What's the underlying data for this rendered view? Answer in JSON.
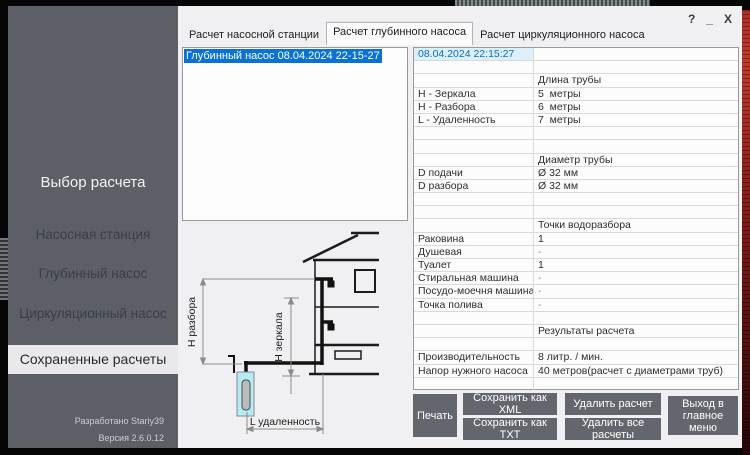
{
  "window_controls": {
    "help": "?",
    "minimize": "_",
    "close": "X"
  },
  "sidebar": {
    "title": "Выбор расчета",
    "items": [
      {
        "label": "Насосная станция",
        "active": false
      },
      {
        "label": "Глубинный насос",
        "active": false
      },
      {
        "label": "Циркуляционный насос",
        "active": false
      },
      {
        "label": "Сохраненные расчеты",
        "active": true
      }
    ],
    "footer": {
      "developed_by": "Разработано  Stariy39",
      "version": "Версия 2.6.0.12"
    }
  },
  "tabs": [
    {
      "label": "Расчет насосной станции",
      "active": false
    },
    {
      "label": "Расчет глубинного насоса",
      "active": true
    },
    {
      "label": "Расчет циркуляционного насоса",
      "active": false
    }
  ],
  "saved_list": {
    "items": [
      {
        "label": "Глубинный насос 08.04.2024 22-15-27",
        "selected": true
      }
    ]
  },
  "diagram": {
    "labels": {
      "h_razbora": "H разбора",
      "h_zerkala": "H зеркала",
      "l_udalennost": "L удаленность"
    },
    "well_color": "#b5ecf4"
  },
  "details_table": {
    "rows": [
      {
        "label": "08.04.2024 22:15:27",
        "value": "",
        "kind": "date"
      },
      {
        "label": "",
        "value": "",
        "kind": "empty"
      },
      {
        "label": "",
        "value": "Длина трубы",
        "kind": "section"
      },
      {
        "label": "H - Зеркала",
        "value": "5  метры",
        "kind": "data"
      },
      {
        "label": "H - Разбора",
        "value": "6  метры",
        "kind": "data"
      },
      {
        "label": "L - Удаленность",
        "value": "7  метры",
        "kind": "data"
      },
      {
        "label": "",
        "value": "",
        "kind": "empty"
      },
      {
        "label": "",
        "value": "",
        "kind": "empty"
      },
      {
        "label": "",
        "value": "Диаметр трубы",
        "kind": "section"
      },
      {
        "label": "D подачи",
        "value": "Ø 32 мм",
        "kind": "data"
      },
      {
        "label": "D разбора",
        "value": "Ø 32 мм",
        "kind": "data"
      },
      {
        "label": "",
        "value": "",
        "kind": "empty"
      },
      {
        "label": "",
        "value": "",
        "kind": "empty"
      },
      {
        "label": "",
        "value": "Точки водоразбора",
        "kind": "section"
      },
      {
        "label": "Раковина",
        "value": "1",
        "kind": "data"
      },
      {
        "label": "Душевая",
        "value": "-",
        "kind": "data"
      },
      {
        "label": "Туалет",
        "value": "1",
        "kind": "data"
      },
      {
        "label": "Стиральная машина",
        "value": "-",
        "kind": "data"
      },
      {
        "label": "Посудо-моечня машина",
        "value": "-",
        "kind": "data"
      },
      {
        "label": "Точка полива",
        "value": "-",
        "kind": "data"
      },
      {
        "label": "",
        "value": "",
        "kind": "empty"
      },
      {
        "label": "",
        "value": "Результаты расчета",
        "kind": "section"
      },
      {
        "label": "",
        "value": "",
        "kind": "empty"
      },
      {
        "label": "Производительность",
        "value": "8 литр. / мин.",
        "kind": "data"
      },
      {
        "label": "Напор нужного насоса",
        "value": "40 метров(расчет с диаметрами труб)",
        "kind": "data"
      },
      {
        "label": "",
        "value": "",
        "kind": "empty"
      }
    ]
  },
  "buttons": {
    "print": "Печать",
    "save_xml": "Сохранить как XML",
    "save_txt": "Сохранить как TXT",
    "delete_calc": "Удалить расчет",
    "delete_all": "Удалить все расчеты",
    "exit": "Выход в главное меню"
  },
  "colors": {
    "sidebar_bg": "#5c6066",
    "selection_blue": "#0a72d5",
    "date_text": "#0a6ebd",
    "date_bg": "#dcf0fa",
    "button_bg": "#63676d",
    "accent_red_wallpaper": "#b32d26"
  }
}
